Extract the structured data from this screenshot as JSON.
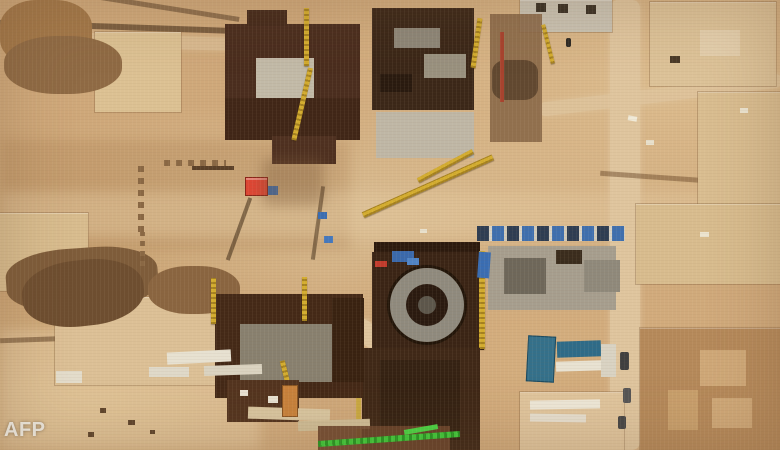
{
  "image": {
    "type": "satellite-photograph",
    "subject": "Aerial satellite view of a large desert construction site (nuclear power plant) with dark building shells, a circular reactor containment ring, cranes, roads and sand pads",
    "watermark": "AFP"
  },
  "palette": {
    "sand_base": "#cfa87a",
    "sand_light": "#dfc59e",
    "dirt_mound": "#7e5c3a",
    "building_brown": "#42281a",
    "concrete_gray": "#b5ada0",
    "crane_yellow": "#d4ad2f",
    "crane_green": "#3fca3a",
    "container_red": "#dd4634",
    "container_blue": "#3a6db2",
    "roof_teal": "#34708a"
  }
}
